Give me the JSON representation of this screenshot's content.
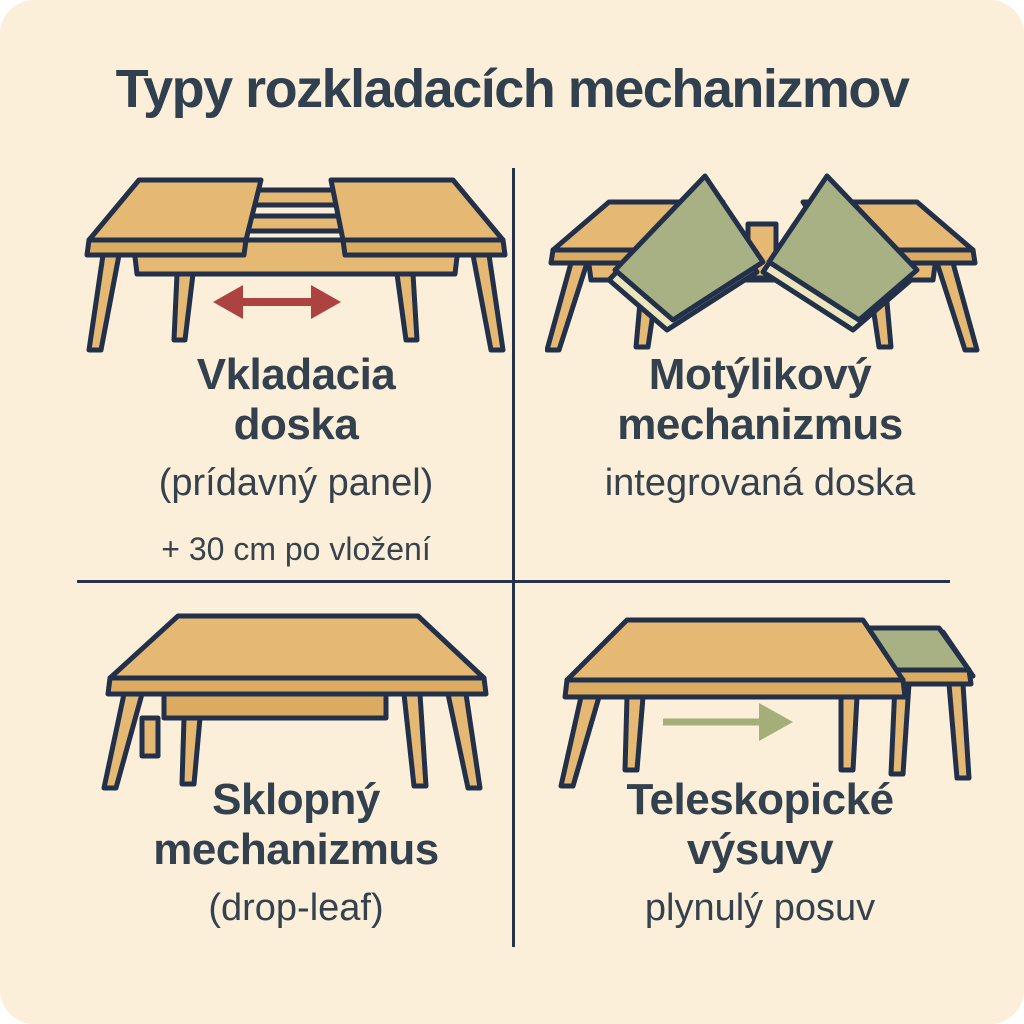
{
  "title": "Typy rozkladacích mechanizmov",
  "quadrants": [
    {
      "id": "insert-leaf",
      "heading_line1": "Vkladacia",
      "heading_line2": "doska",
      "subheading": "(prídavný panel)",
      "note": "+ 30 cm po vložení"
    },
    {
      "id": "butterfly",
      "heading_line1": "Motýlikový",
      "heading_line2": "mechanizmus",
      "subheading": "integrovaná doska"
    },
    {
      "id": "drop-leaf",
      "heading_line1": "Sklopný",
      "heading_line2": "mechanizmus",
      "subheading": "(drop-leaf)"
    },
    {
      "id": "telescopic",
      "heading_line1": "Teleskopické",
      "heading_line2": "výsuvy",
      "subheading": "plynulý posuv"
    }
  ],
  "icons": {
    "red_double_arrow": "horizontal-double-arrow",
    "green_right_arrow": "right-arrow"
  },
  "colors": {
    "background": "#fbefd9",
    "outer_background": "#ffffff",
    "outline_ink": "#22304a",
    "text": "#33414f",
    "wood": "#e5b873",
    "wood_dark": "#dcab62",
    "leaf_green": "#a8b184",
    "leaf_edge_cream": "#ece5bd",
    "arrow_red": "#ad4340",
    "arrow_green": "#a4ae78",
    "divider": "#24334a"
  }
}
